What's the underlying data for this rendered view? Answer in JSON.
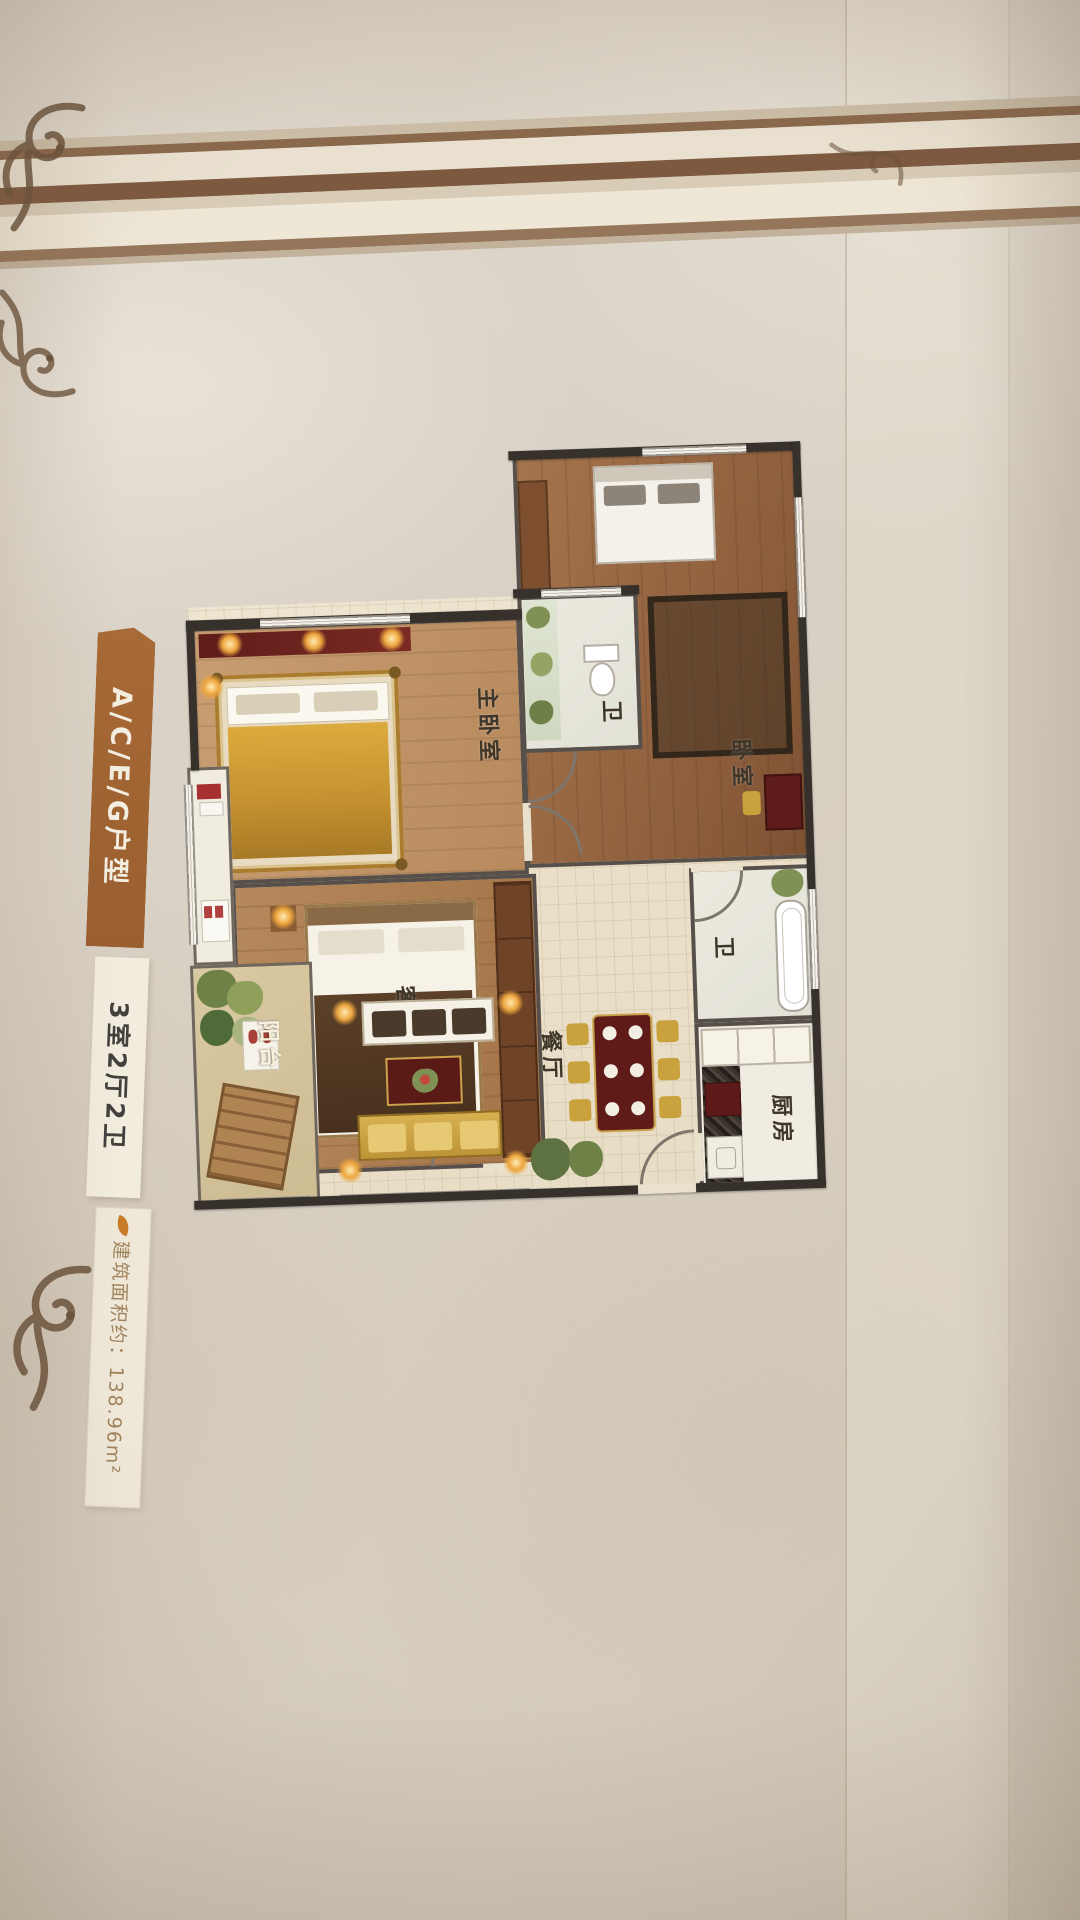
{
  "poster": {
    "unit_type_label": "A/C/E/G户型",
    "layout_label": "3室2厅2卫",
    "area_label": "建筑面积约：138.96m²"
  },
  "floorplan": {
    "master_bedroom": "主卧室",
    "bedroom_top_right": "卧室",
    "bedroom_left": "卧室",
    "bathroom_top": "卫",
    "bathroom_middle": "卫",
    "kitchen": "厨房",
    "living_room": "客厅",
    "dining_room": "餐厅",
    "balcony": "阳台"
  }
}
